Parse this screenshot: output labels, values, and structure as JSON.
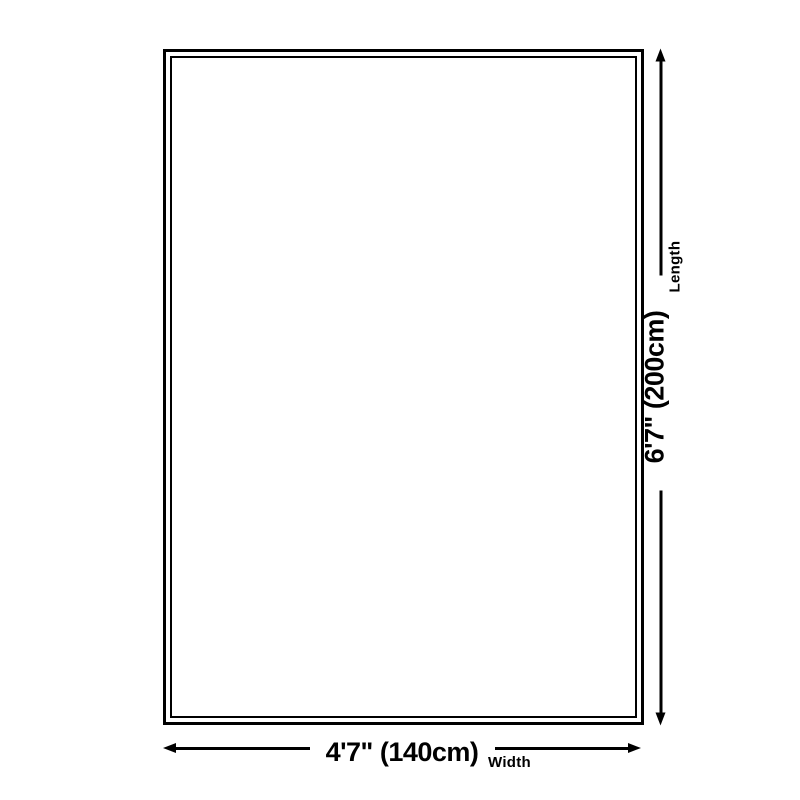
{
  "colors": {
    "background": "#ffffff",
    "line": "#000000",
    "text": "#000000"
  },
  "icons": {
    "arrow_up": "css-triangle-up",
    "arrow_down": "css-triangle-down",
    "arrow_left": "css-triangle-left",
    "arrow_right": "css-triangle-right"
  },
  "length_dimension": {
    "value": "6'7\" (200cm)",
    "label": "Length"
  },
  "width_dimension": {
    "value": "4'7\" (140cm)",
    "label": "Width"
  }
}
